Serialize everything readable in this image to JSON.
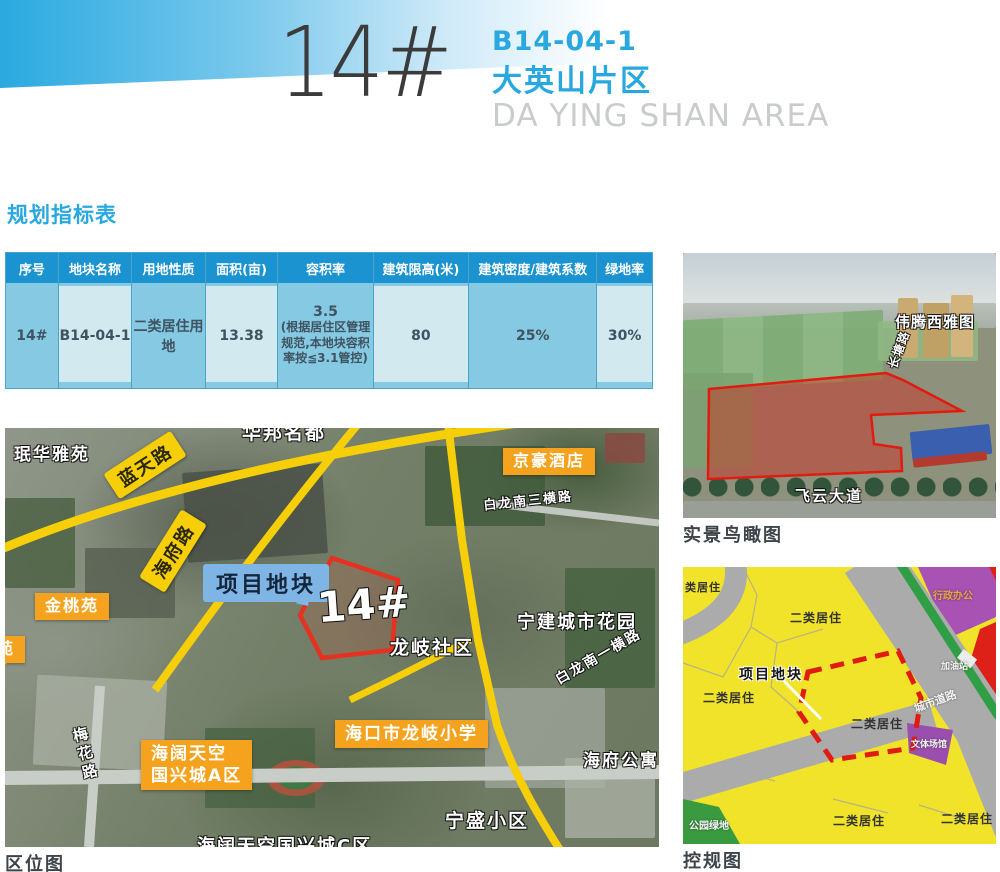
{
  "header": {
    "number": "14#",
    "code": "B14-04-1",
    "district": "大英山片区",
    "district_en": "DA YING SHAN AREA"
  },
  "table": {
    "title": "规划指标表",
    "columns": [
      "序号",
      "地块名称",
      "用地性质",
      "面积(亩)",
      "容积率",
      "建筑限高(米)",
      "建筑密度/建筑系数",
      "绿地率"
    ],
    "row": {
      "serial": "14#",
      "name": "B14-04-1",
      "landuse": "二类居住用地",
      "area": "13.38",
      "far": "3.5",
      "far_note": "(根据居住区管理规范,本地块容积率按≦3.1管控)",
      "height": "80",
      "density": "25%",
      "green": "30%"
    }
  },
  "location_map": {
    "caption": "区位图",
    "labels": {
      "minhua": "珉华雅苑",
      "huabang": "华邦名都",
      "lantian": "蓝天路",
      "jinghao": "京豪酒店",
      "bailong3": "白龙南三横路",
      "haifu_road": "海府路",
      "project": "项目地块",
      "mark": "14#",
      "longqi": "龙岐社区",
      "ningjian": "宁建城市花园",
      "bailong1": "白龙南一横路",
      "jintao": "金桃苑",
      "yuan": "苑",
      "meihua": "梅花路",
      "hktk1": "海阔天空",
      "hktk2": "国兴城A区",
      "school": "海口市龙岐小学",
      "haifu_apt": "海府公寓",
      "ningsheng": "宁盛小区",
      "xingcheng_c": "海阔天空国兴城C区"
    }
  },
  "aerial_view": {
    "caption": "实景鸟瞰图",
    "labels": {
      "weiteng": "伟腾西雅图",
      "road": "长塘路",
      "avenue": "飞云大道"
    }
  },
  "zoning_map": {
    "caption": "控规图",
    "labels": {
      "residential": "二类居住",
      "residential_partial": "类居住",
      "project": "项目地块",
      "admin": "行政办公",
      "venue": "文体场馆",
      "park": "公园绿地",
      "road": "城市道路",
      "gas": "加油站"
    }
  },
  "colors": {
    "accent": "#29a8e0",
    "table_header": "#1b93d0",
    "cell_medium": "#85c9e2",
    "cell_light": "#d3e9f0",
    "road_yellow": "#f6cf08",
    "label_orange": "#f5a31f",
    "boundary_red": "#e5311f",
    "project_label_blue": "#7fb5e5",
    "zone_yellow": "#f0e32a",
    "zone_purple": "#a852b4",
    "zone_green": "#2f9e44",
    "zone_road_gray": "#ababab"
  }
}
